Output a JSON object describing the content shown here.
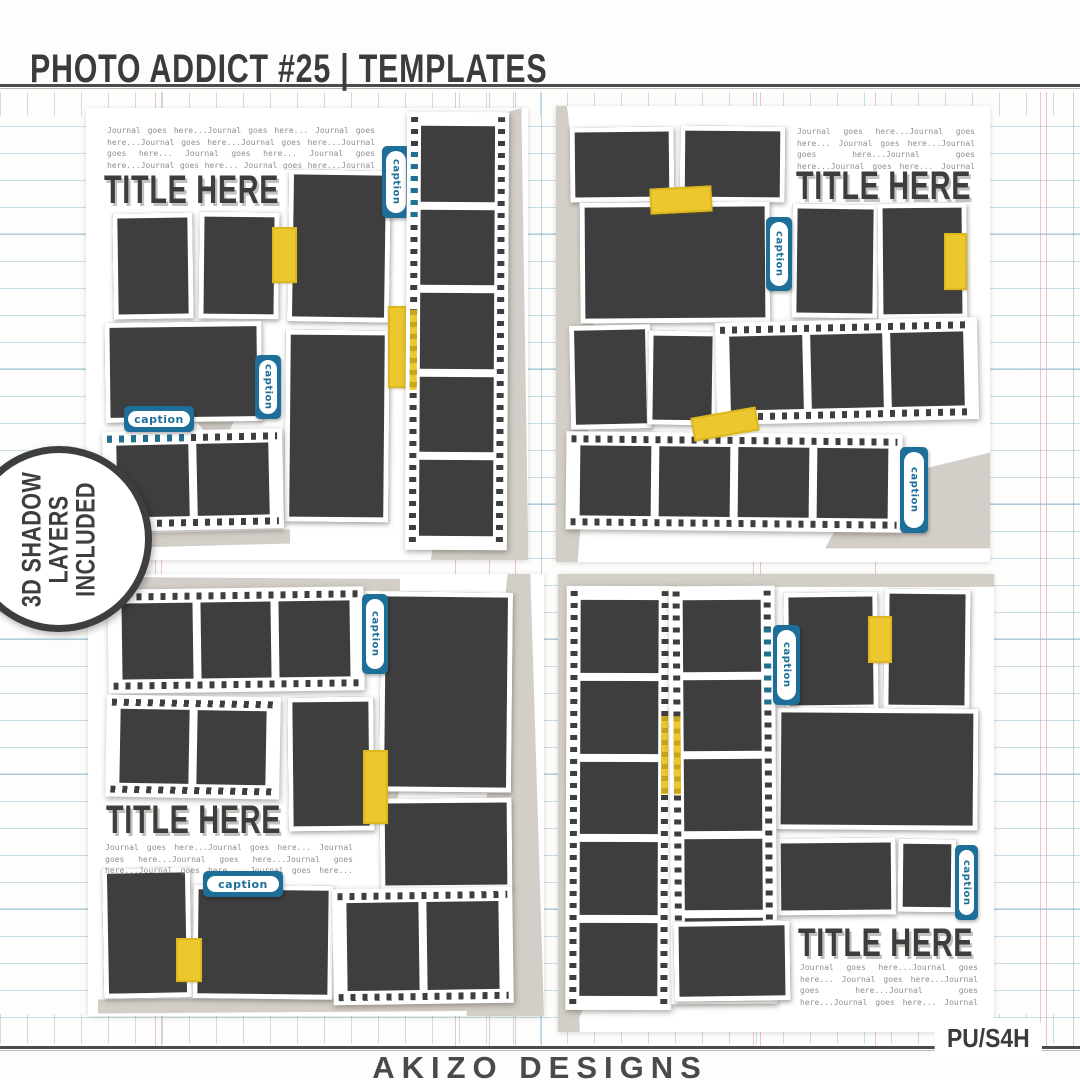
{
  "header": {
    "title": "PHOTO ADDICT #25 | TEMPLATES"
  },
  "badge": {
    "line1": "3D SHADOW",
    "line2": "LAYERS",
    "line3": "INCLUDED"
  },
  "footer": {
    "brand": "AKIZO DESIGNS",
    "license": "PU/S4H"
  },
  "templates": {
    "title": "TITLE HERE",
    "caption_label": "caption",
    "journal_text": "Journal goes here...Journal goes here... Journal goes here...Journal goes here...Journal goes here...Journal goes here... Journal goes here... Journal goes here...Journal goes here... Journal goes here...Journal goes here... Journal goes here...Journal goes here... Journal goes here..."
  },
  "colors": {
    "photo_placeholder": "#3e3e3e",
    "caption_blue": "#1d6f9a",
    "tape_yellow": "#ecc72e",
    "shadow_gray": "#d3cec7",
    "ink": "#3b3b3b"
  }
}
